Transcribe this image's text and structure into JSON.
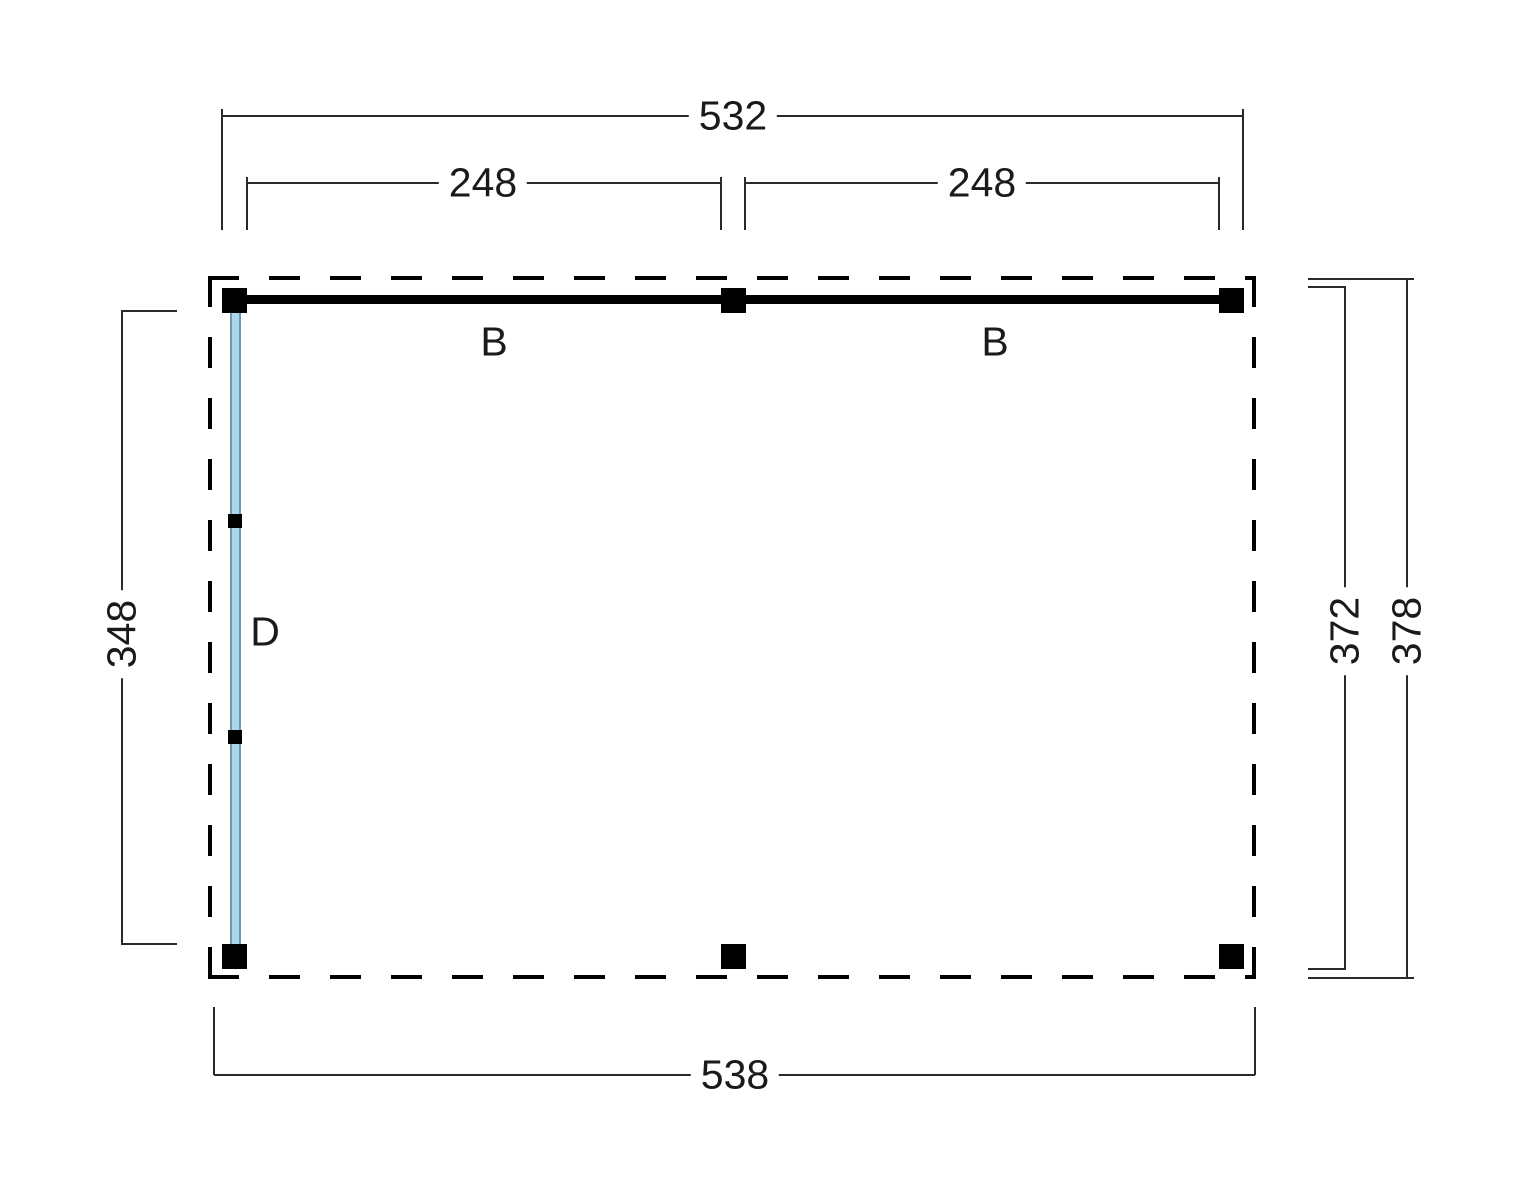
{
  "diagram": {
    "type": "floorplan-top-view",
    "dims": {
      "top_overall": "532",
      "top_span_left": "248",
      "top_span_right": "248",
      "bottom_overall": "538",
      "left_height": "348",
      "right_inner": "372",
      "right_outer": "378"
    },
    "labels": {
      "beam_left": "B",
      "beam_right": "B",
      "wall_left": "D"
    },
    "colors": {
      "line": "#2a2a2a",
      "beam": "#000000",
      "post": "#000000",
      "roof_outline": "#000000",
      "wall_fill": "#abd7ec",
      "wall_edge": "#7796a8"
    }
  }
}
